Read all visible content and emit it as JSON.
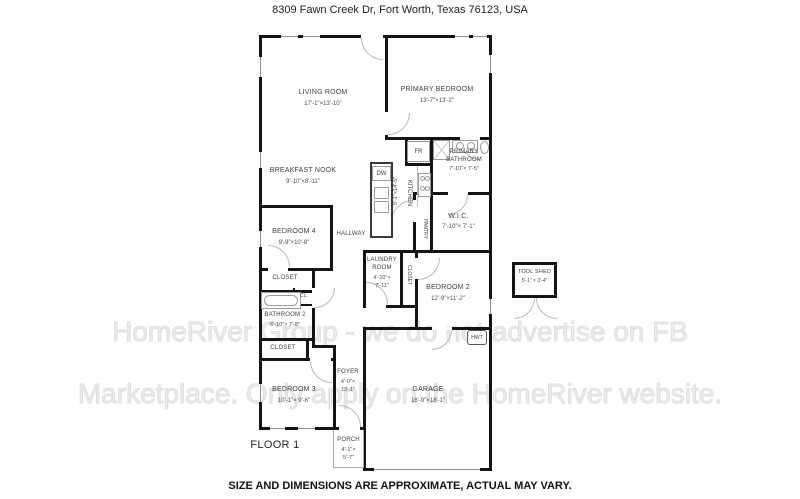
{
  "title": "8309 Fawn Creek Dr, Fort Worth, Texas 76123, USA",
  "disclaimer": "SIZE AND DIMENSIONS ARE APPROXIMATE, ACTUAL MAY VARY.",
  "floor_label": "FLOOR 1",
  "watermark": {
    "line1": "HomeRiver Group - we do not advertise on FB",
    "line2": "Marketplace. Only apply on the HomeRiver website."
  },
  "colors": {
    "wall": "#141414",
    "door_arc": "#b8b8b8",
    "fixture_outline": "#9b9b9b",
    "label_text": "#3d3d3d",
    "watermark_text": "#ececec"
  },
  "rooms": {
    "living_room": {
      "name": "LIVING ROOM",
      "dims": "17'-1\"×13'-10\""
    },
    "primary_bedroom": {
      "name": "PRIMARY BEDROOM",
      "dims": "13'-7\"×13'-2\""
    },
    "breakfast_nook": {
      "name": "BREAKFAST NOOK",
      "dims": "9'-10\"×8'-11\""
    },
    "primary_bathroom": {
      "name": "PRIMARY BATHROOM",
      "dims": "7'-10\"× 7'-5\""
    },
    "kitchen": {
      "name": "KITCHEN",
      "dims": "9'-1\"×14'-5\""
    },
    "wic": {
      "name": "W.I.C.",
      "dims": "7'-10\"× 7'-1\""
    },
    "pantry": {
      "name": "PANTRY"
    },
    "bedroom4": {
      "name": "BEDROOM 4",
      "dims": "9'-9\"×10'-8\""
    },
    "hallway": {
      "name": "HALLWAY"
    },
    "laundry_room": {
      "name": "LAUNDRY ROOM",
      "dims": "4'-10\"×\n7'-11\""
    },
    "closet_laundry": {
      "name": "CLOSET"
    },
    "bedroom2": {
      "name": "BEDROOM 2",
      "dims": "12'-9\"×11'-2\""
    },
    "tool_shed": {
      "name": "TOOL SHED",
      "dims": "5'-1\" × 3'-4\""
    },
    "closet_bedroom4": {
      "name": "CLOSET"
    },
    "cl": {
      "name": "CL."
    },
    "bathroom2": {
      "name": "BATHROOM 2",
      "dims": "6'-10\"× 7'-8\""
    },
    "closet_bedroom3": {
      "name": "CLOSET"
    },
    "bedroom3": {
      "name": "BEDROOM 3",
      "dims": "10'-1\"× 9'-6\""
    },
    "foyer": {
      "name": "FOYER",
      "dims": "4'-0\"×\n13'-1\""
    },
    "garage": {
      "name": "GARAGE",
      "dims": "16'-9\"×18'-1\""
    },
    "porch": {
      "name": "PORCH",
      "dims": "4'-1\"×\n5'-7\""
    }
  },
  "fixtures": {
    "dw": "DW",
    "fr": "FR",
    "hwt": "HWT"
  }
}
